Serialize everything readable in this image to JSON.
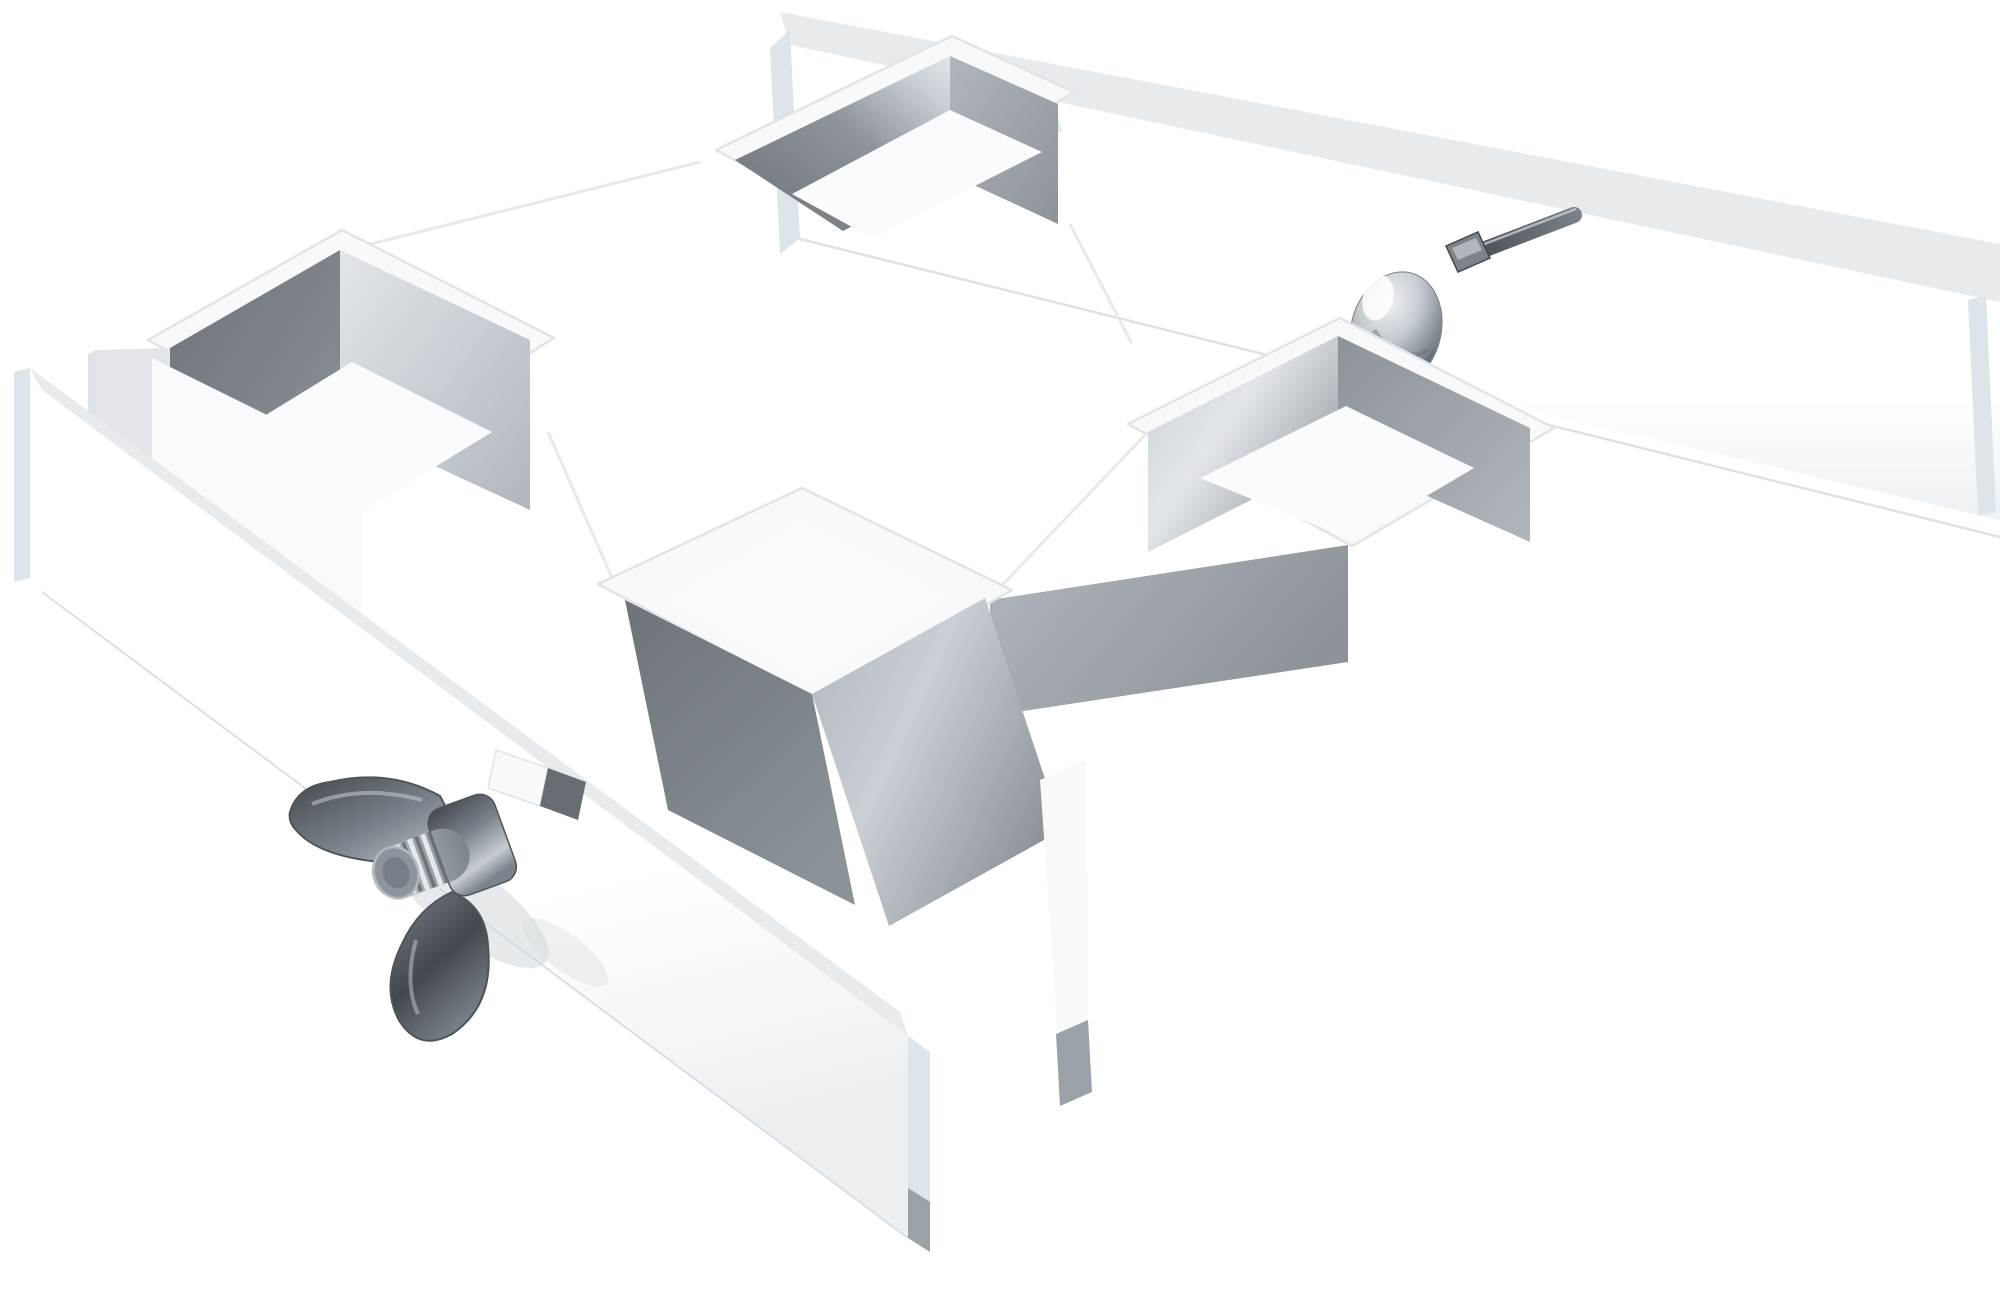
{
  "meta": {
    "title": "3D render of a white steel cross clamp for square tubes with wing nut and dome-head bolt"
  },
  "scene": {
    "background": "#ffffff",
    "object_type": "square-tube cross clamp, floating on white, axonometric view",
    "parts": [
      {
        "name": "rear-clamp-bar",
        "description": "long flat white bar running shallow diagonal, behind the cross body"
      },
      {
        "name": "front-clamp-bar",
        "description": "long flat white bar running steep diagonal, in front of the cross body"
      },
      {
        "name": "pocket-top",
        "description": "U-channel pocket, top center, gray inner walls"
      },
      {
        "name": "pocket-left",
        "description": "U-channel pocket, left, dark inner wall"
      },
      {
        "name": "pocket-right",
        "description": "U-channel pocket, right, lit inner wall"
      },
      {
        "name": "pocket-bottom",
        "description": "U-channel pocket, bottom center, dark inner wall"
      },
      {
        "name": "wing-nut",
        "description": "steel butterfly wing nut on threaded stud, lower left on front bar"
      },
      {
        "name": "threaded-stud",
        "description": "threaded bolt end protruding through wing nut"
      },
      {
        "name": "dome-bolt-head",
        "description": "polished mushroom/carriage bolt head on rear bar face"
      },
      {
        "name": "threaded-rod",
        "description": "dark threaded rod poking out above rear bar, upper right"
      },
      {
        "name": "slot-tab",
        "description": "small tab and punched slot where front bar meets the cross body"
      }
    ]
  },
  "palette": {
    "bg": "#ffffff",
    "bodyFill": "#f8fafb",
    "collarFill": "#f7f9fa",
    "bodyStroke": "#e0e5e9",
    "edgeStrip": "#e7ebee",
    "edgeStripDark": "#dce3e9",
    "endCap": "#dde4ea",
    "railWhite": "#ffffff",
    "railShade": "#edf0f3",
    "railBottomLine": "#d8dde2",
    "wallDark1": "#6d7379",
    "wallDark2": "#8b9298",
    "wallMid1": "#8d9399",
    "wallMid2": "#b0b6bc",
    "wallLight1": "#c9cfd4",
    "wallLight2": "#e2e6ea",
    "floorWhite": "#fafbfc",
    "shadowSoft": "#d0d6da",
    "specular": "#dfe9f2",
    "bevelLine": "#e3e7ea",
    "slotDark": "#676d73",
    "steelDark": "#42474d",
    "steelMid": "#7c838a",
    "steelLight": "#c6ccd2",
    "steelHi": "#eef1f3",
    "domeDark": "#5f666c",
    "glint": "#ffffff",
    "wingStroke": "#4e545a",
    "tipFace": "#8d949b",
    "tipRim": "#b2b9bf",
    "tipCore": "#70777e",
    "grayTip": "#9aa1a7"
  }
}
